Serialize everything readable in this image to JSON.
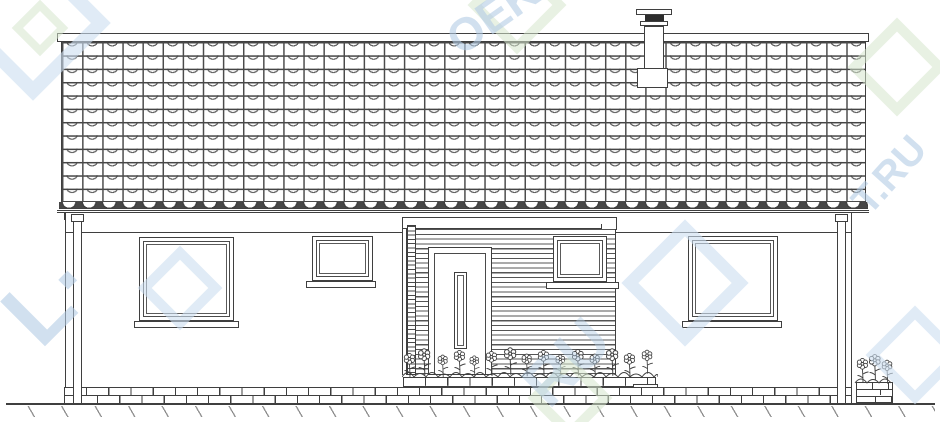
{
  "document": {
    "type_label": "House facade elevation drawing",
    "background_color": "#ffffff",
    "line_color": "#3f3f3f"
  },
  "watermark": {
    "color_blue": "#cbdeF0",
    "color_green": "#d5e6cc",
    "fragments": [
      {
        "id": "logo-left",
        "text": "L·"
      },
      {
        "id": "text-top",
        "text": "OEKT"
      },
      {
        "id": "text-right",
        "text": "T.RU"
      },
      {
        "id": "text-center",
        "text": "RU"
      }
    ]
  },
  "elements": {
    "roof": {
      "name": "tiled-roof",
      "tile_rows": 12,
      "tile_columns": 40,
      "ridge_band": true
    },
    "chimney": {
      "name": "chimney",
      "cap": "dark-band-cap",
      "position": "right-of-center"
    },
    "windows": [
      {
        "name": "left-large-window",
        "sill": true
      },
      {
        "name": "left-small-window",
        "sill": true
      },
      {
        "name": "entry-bay-window",
        "sill": true
      },
      {
        "name": "right-large-window",
        "sill": true
      }
    ],
    "door": {
      "name": "entry-door",
      "glazing": "vertical-slot"
    },
    "entry_bay": {
      "name": "entry-bay",
      "cladding": "horizontal-siding",
      "header_band": true,
      "brick-pilaster": true
    },
    "downspouts": 2,
    "plinth": {
      "material": "brick",
      "courses_main": 2,
      "courses_porch": 3
    },
    "porch_step": true,
    "planter": {
      "name": "flower-planter",
      "position": "bottom-right",
      "material": "brick"
    },
    "flower_beds": 2,
    "ground": {
      "name": "ground-line",
      "hatching": true
    }
  }
}
